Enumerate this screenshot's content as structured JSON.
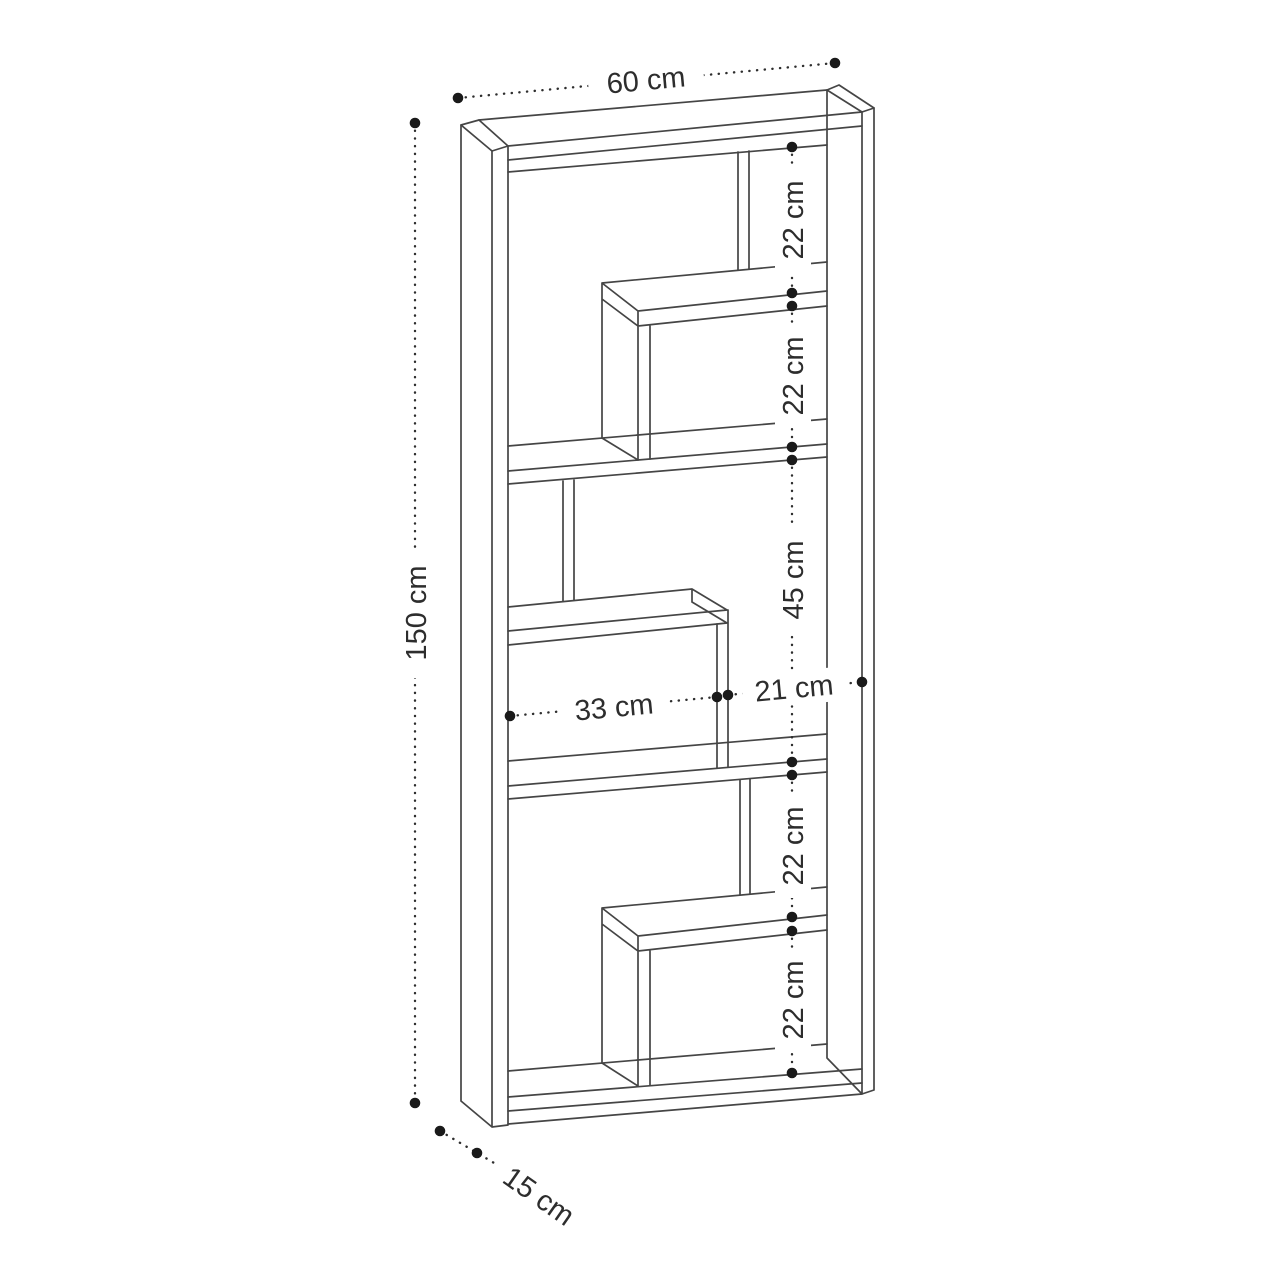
{
  "diagram": {
    "subject": "bookcase dimension drawing",
    "units": "cm",
    "labels": {
      "width": "60 cm",
      "height": "150 cm",
      "depth": "15 cm",
      "sections": [
        "22 cm",
        "22 cm",
        "45 cm",
        "22 cm",
        "22 cm"
      ],
      "inner_left_width": "33 cm",
      "inner_right_width": "21 cm"
    },
    "measurements": {
      "width_cm": 60,
      "height_cm": 150,
      "depth_cm": 15,
      "section_heights_cm": [
        22,
        22,
        45,
        22,
        22
      ],
      "inner_widths_cm": {
        "left": 33,
        "right": 21
      }
    },
    "colors": {
      "background": "#ffffff",
      "line": "#454545",
      "dimension_line": "#2e2e2e",
      "dot": "#1a1a1a",
      "text": "#2d2d2d"
    }
  }
}
